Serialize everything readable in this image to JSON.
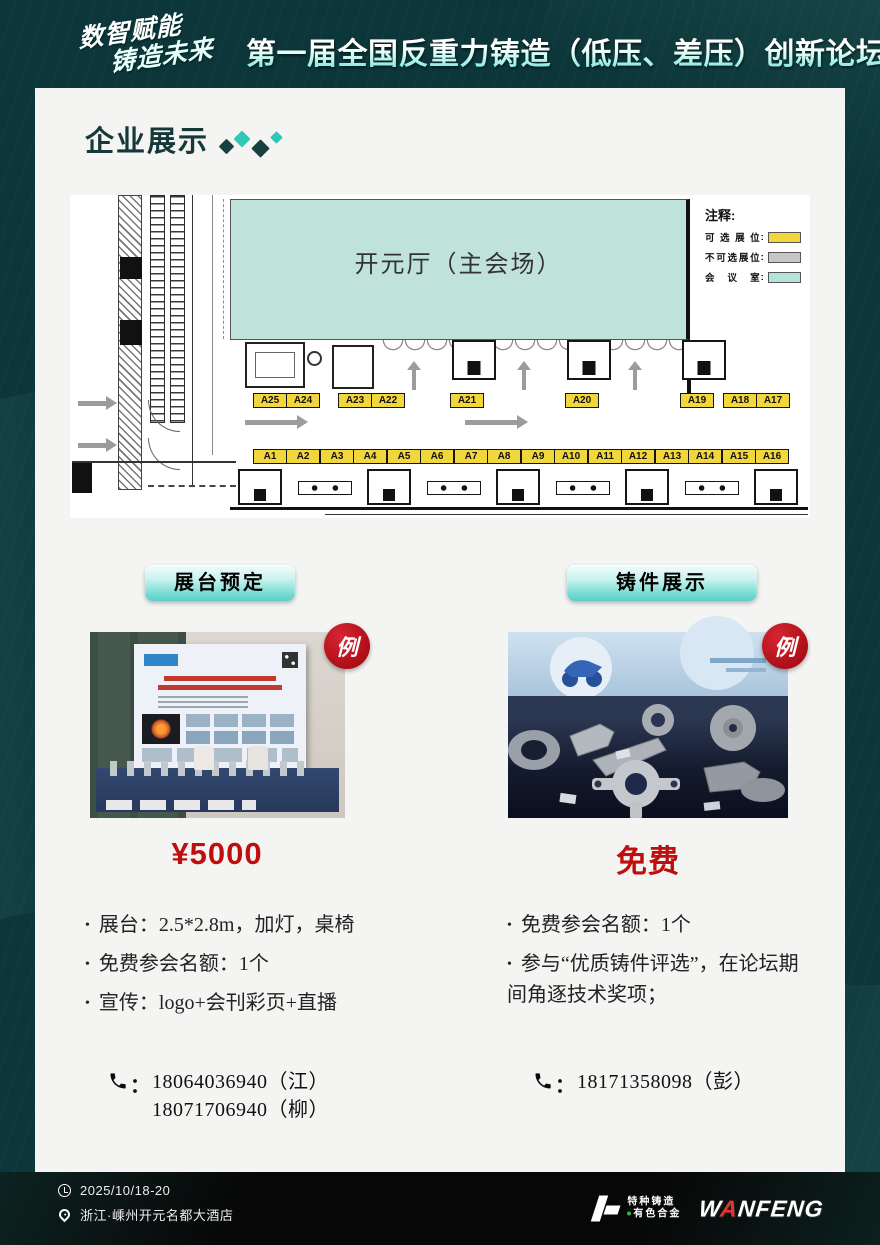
{
  "header": {
    "logo_line1": "数智赋能",
    "logo_line2": "铸造未来",
    "title": "第一届全国反重力铸造（低压、差压）创新论坛"
  },
  "section": {
    "title": "企业展示"
  },
  "floorplan": {
    "hall_label": "开元厅（主会场）",
    "legend": {
      "title": "注释:",
      "colon": ":",
      "items": [
        {
          "label": "可选展位",
          "color": "#f2d73c"
        },
        {
          "label": "不可选展位",
          "color": "#c6c6c6"
        },
        {
          "label": "会议室",
          "color": "#b5e3da"
        }
      ]
    },
    "booths_top": [
      [
        "A25",
        "A24"
      ],
      [
        "A23",
        "A22"
      ],
      [
        "A21"
      ],
      [
        "A20"
      ],
      [
        "A19"
      ],
      [
        "A18",
        "A17"
      ]
    ],
    "booths_bottom": [
      [
        "A1",
        "A2"
      ],
      [
        "A3",
        "A4"
      ],
      [
        "A5",
        "A6"
      ],
      [
        "A7",
        "A8"
      ],
      [
        "A9",
        "A10"
      ],
      [
        "A11",
        "A12"
      ],
      [
        "A13",
        "A14"
      ],
      [
        "A15",
        "A16"
      ]
    ]
  },
  "columns": {
    "left": {
      "button": "展台预定",
      "badge": "例",
      "price": "¥5000",
      "bullets": [
        "展台：2.5*2.8m，加灯，桌椅",
        "免费参会名额：1个",
        "宣传：logo+会刊彩页+直播"
      ],
      "phone_colon": "：",
      "phones": [
        "18064036940（江）",
        "18071706940（柳）"
      ]
    },
    "right": {
      "button": "铸件展示",
      "badge": "例",
      "price": "免费",
      "bullets": [
        "免费参会名额：1个",
        "参与“优质铸件评选”，在论坛期间角逐技术奖项；"
      ],
      "phone_colon": "：",
      "phones": [
        "18171358098（彭）"
      ]
    }
  },
  "footer": {
    "date": "2025/10/18-20",
    "venue": "浙江·嵊州开元名都大酒店",
    "logo1_line1": "特种铸造",
    "logo1_line2": "有色合金",
    "logo2_w": "W",
    "logo2_a": "A",
    "logo2_rest": "NFENG"
  },
  "colors": {
    "background": "#0c3639",
    "card": "#f4f5f3",
    "accent_teal": "#2fc7b7",
    "booth_yellow": "#f2d73c",
    "hall_teal": "#bfe3db",
    "price_red": "#c00d0d",
    "badge_red": "#c1121c"
  }
}
